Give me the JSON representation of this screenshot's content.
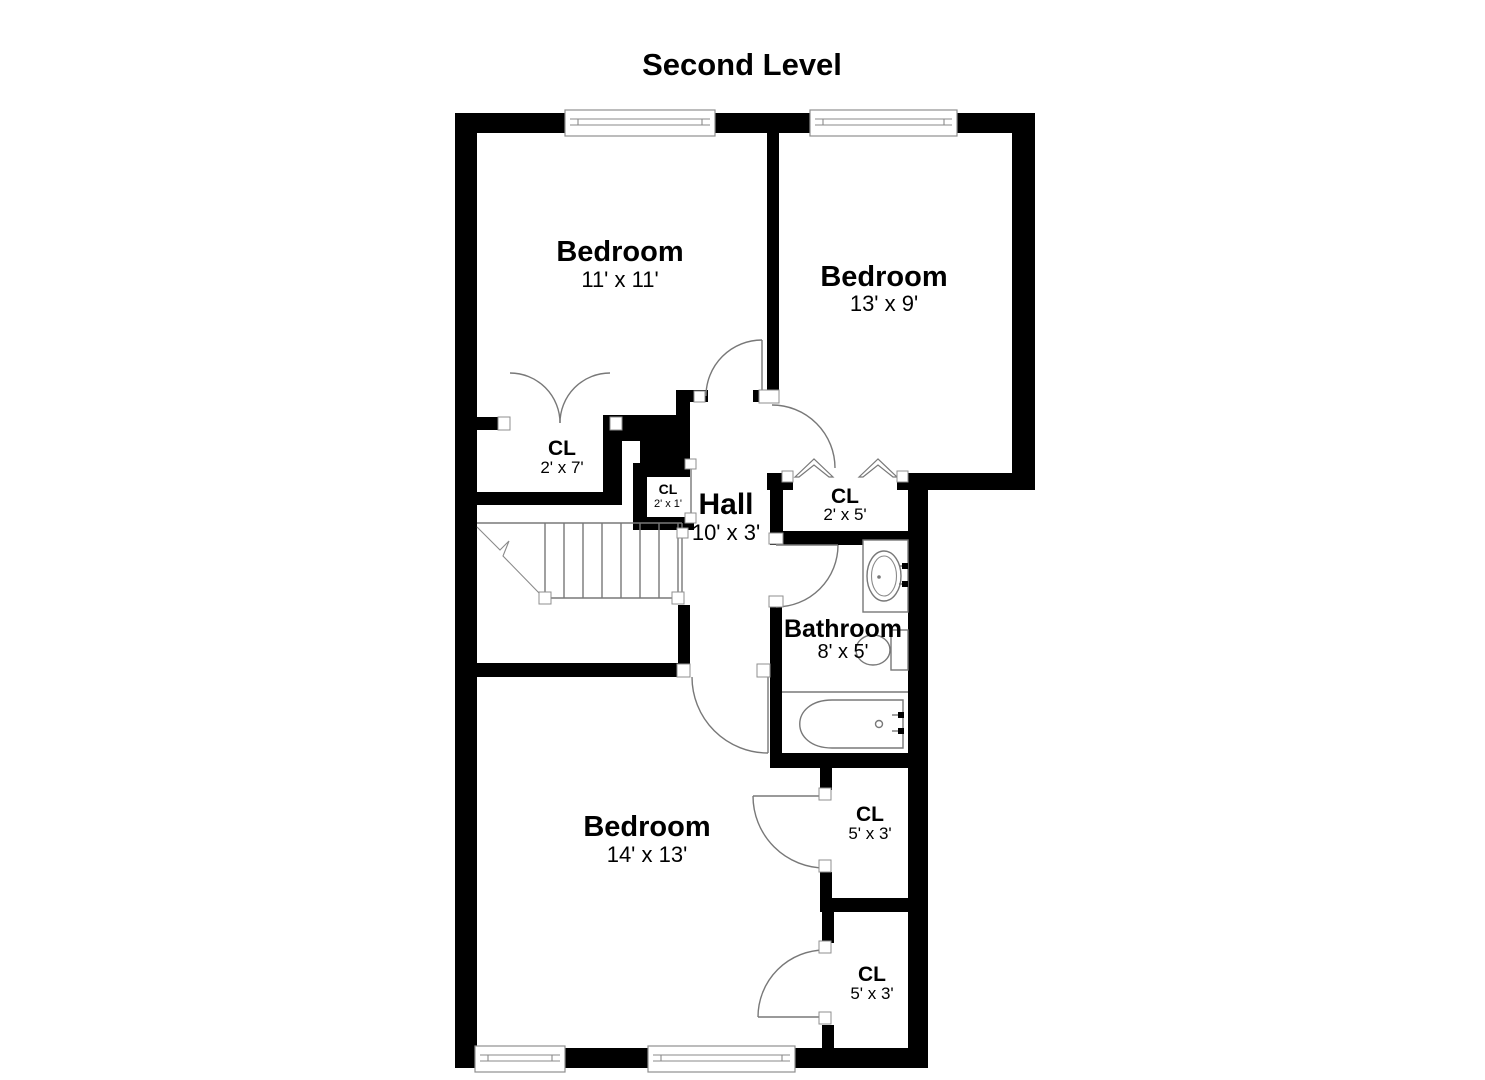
{
  "title": "Second Level",
  "rooms": {
    "bedroom_top_left": {
      "name": "Bedroom",
      "dims": "11' x 11'"
    },
    "bedroom_top_right": {
      "name": "Bedroom",
      "dims": "13' x 9'"
    },
    "closet_2x7": {
      "name": "CL",
      "dims": "2' x 7'"
    },
    "closet_2x1": {
      "name": "CL",
      "dims": "2' x 1'"
    },
    "hall": {
      "name": "Hall",
      "dims": "10' x 3'"
    },
    "closet_2x5": {
      "name": "CL",
      "dims": "2' x 5'"
    },
    "bathroom": {
      "name": "Bathroom",
      "dims": "8' x 5'"
    },
    "bedroom_bottom": {
      "name": "Bedroom",
      "dims": "14' x 13'"
    },
    "closet_upper_5x3": {
      "name": "CL",
      "dims": "5' x 3'"
    },
    "closet_lower_5x3": {
      "name": "CL",
      "dims": "5' x 3'"
    }
  },
  "colors": {
    "wall": "#000000",
    "thin_line": "#787878",
    "background": "#ffffff",
    "text": "#000000"
  }
}
